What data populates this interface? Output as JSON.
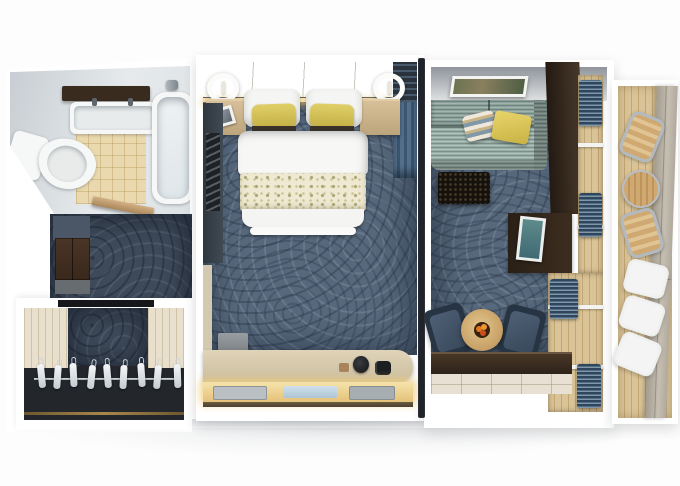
{
  "scene": {
    "label": "Cruise ship suite 3D top-down floor plan render",
    "view": "top-down cutaway",
    "background": "#ffffff"
  },
  "palette": {
    "carpet_blue": "#57687c",
    "hall_carpet": "#3e4a59",
    "deck_wood": "#d8c295",
    "dark_wood": "#3c2d22",
    "accent_yellow": "#d8c75c",
    "sofa_gray_green": "#8da19b",
    "armchair_blue": "#3a4a5e",
    "curtain_blue": "#47637d",
    "desk_glow": "#eccf8e",
    "fixture_white": "#f6f7f7",
    "taupe_wall": "#b4ada1",
    "gold_trim": "#8d7340",
    "fruit_orange": "#e07a1e"
  },
  "rooms": {
    "bathroom": {
      "label": "Bathroom",
      "furniture": [
        "vanity-shelf",
        "sink",
        "bathtub",
        "toilet",
        "tiled-floor"
      ]
    },
    "entry_hall": {
      "label": "Entry hall",
      "furniture": [
        "wardrobe-cabinet",
        "luggage-bench",
        "door-threshold"
      ]
    },
    "closet": {
      "label": "Walk-in closet",
      "furniture": [
        "hanging-rail",
        "clothes-hangers",
        "wood-panelling"
      ],
      "hanger_count": 9
    },
    "bedroom": {
      "label": "Bedroom",
      "furniture": [
        "king-bed",
        "nightstand-left",
        "nightstand-right",
        "wall-lamp-left",
        "wall-lamp-right",
        "framed-art",
        "accent-curtain",
        "vanity-desk",
        "lit-shelf",
        "stool-box"
      ],
      "bed": {
        "white_pillows": 2,
        "accent_pillows": 2,
        "accent_pillow_color": "#d8c75c",
        "runner_pattern": "yellow floral on cream"
      }
    },
    "living_room": {
      "label": "Living room",
      "furniture": [
        "wall-art",
        "sofa",
        "striped-pillow",
        "yellow-pillow",
        "ottoman",
        "media-cabinet",
        "leaning-art",
        "armchair-left",
        "armchair-right",
        "round-table",
        "fruit-bowl",
        "balcony-window",
        "curtains"
      ]
    },
    "balcony": {
      "label": "Balcony",
      "furniture": [
        "bistro-table",
        "deck-chair-upper",
        "deck-chair-lower",
        "sun-lounger",
        "deck-planks"
      ]
    }
  }
}
